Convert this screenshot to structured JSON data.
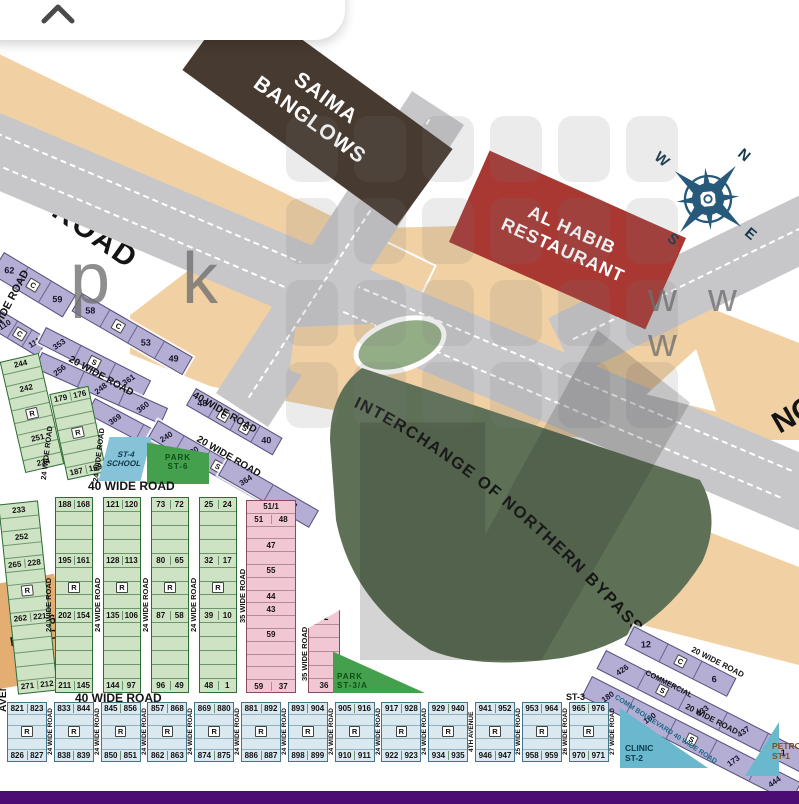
{
  "landmarks": {
    "saima": [
      "SAIMA",
      "BANGLOWS"
    ],
    "alhabib": [
      "AL HABIB",
      "RESTAURANT"
    ],
    "interchange": "INTERCHANGE OF NORTHERN BYPASS",
    "masjid": [
      "ST-6",
      "MASJID"
    ],
    "school": [
      "ST-4",
      "SCHOOL"
    ],
    "park_st6": [
      "PARK",
      "ST-6"
    ],
    "park_st3a": [
      "PARK",
      "ST-3/A"
    ],
    "clinic": [
      "CLINIC",
      "ST-2"
    ],
    "petrol": [
      "PETROL",
      "ST-1"
    ],
    "st3": "ST-3",
    "comm_boulevard": "COMM BOULEVARD 40 WIDE ROAD",
    "commercial": "COMMERCIAL",
    "northern_partial": "NO"
  },
  "compass": {
    "n": "N",
    "e": "E",
    "s": "S",
    "w": "W"
  },
  "watermarks": {
    "left": "p k",
    "right": "w w w"
  },
  "roads": {
    "top_left": "WIDE ROAD",
    "left_upper": "40 WIDE ROAD",
    "left_lower": "AVENUE 40 WIDE ROAD",
    "header_top": "40 WIDE ROAD",
    "header_bottom": "40 WIDE ROAD",
    "r20": "20 WIDE ROAD",
    "r40": "40 WIDE ROAD",
    "v24": "24 WIDE ROAD",
    "v35": "35 WIDE ROAD"
  },
  "strips": {
    "s1": [
      "62",
      "C",
      "59"
    ],
    "s2": [
      "58",
      "C",
      "53",
      "49"
    ],
    "s3": [
      "110",
      "C",
      "111"
    ],
    "s4": [
      "353",
      "S",
      "361"
    ],
    "s5": [
      "256",
      "248",
      "360"
    ],
    "s6": [
      "369",
      "241"
    ],
    "s7": [
      "48",
      "C",
      "S",
      "40"
    ],
    "s8": [
      "240",
      "230",
      "S",
      "231",
      "078"
    ],
    "s9": [
      "364",
      "223"
    ],
    "t1": [
      "12",
      "C",
      "6"
    ],
    "t2": [
      "426",
      "S",
      "433",
      "437",
      "1"
    ],
    "t3": [
      "180",
      "160",
      "S",
      "173",
      "444"
    ]
  },
  "greenUpper": {
    "colA": [
      "244",
      "",
      "242",
      "",
      "R",
      "",
      "251",
      "",
      "234"
    ],
    "colB": [
      "179 176",
      "",
      "",
      "R",
      "",
      "",
      "187 169"
    ]
  },
  "greenColumns": {
    "c1": [
      "233",
      "",
      "252",
      "",
      "265 228",
      "",
      "R",
      "",
      "262 221",
      "",
      "",
      "",
      "",
      "271 212"
    ],
    "c2": [
      "188 168",
      "",
      "",
      "",
      "195 161",
      "",
      "R",
      "",
      "202 154",
      "",
      "",
      "",
      "",
      "211 145"
    ],
    "c3": [
      "121 120",
      "",
      "",
      "",
      "128 113",
      "",
      "R",
      "",
      "135 106",
      "",
      "",
      "",
      "",
      "144 97"
    ],
    "c4": [
      "73 72",
      "",
      "",
      "",
      "80 65",
      "",
      "R",
      "",
      "87 58",
      "",
      "",
      "",
      "",
      "96 49"
    ],
    "c5": [
      "25 24",
      "",
      "",
      "",
      "32 17",
      "",
      "R",
      "",
      "39 10",
      "",
      "",
      "",
      "",
      "48 1"
    ]
  },
  "pink": {
    "col1": [
      "51/1",
      "51 48",
      "",
      "47",
      "",
      "55",
      "",
      "44",
      "43",
      "",
      "59",
      "",
      "",
      "",
      "59 37"
    ],
    "col2": [
      "32",
      "",
      "",
      "",
      "",
      "36"
    ]
  },
  "bottom": {
    "blocks": [
      {
        "top": "821 823",
        "bottom": "826 827"
      },
      {
        "top": "833 844",
        "bottom": "838 839"
      },
      {
        "top": "845 856",
        "bottom": "850 851"
      },
      {
        "top": "857 868",
        "bottom": "862 863"
      },
      {
        "top": "869 880",
        "bottom": "874 875"
      },
      {
        "top": "881 892",
        "bottom": "886 887"
      },
      {
        "top": "893 904",
        "bottom": "898 899"
      },
      {
        "top": "905 916",
        "bottom": "910 911"
      },
      {
        "top": "917 928",
        "bottom": "922 923"
      },
      {
        "top": "929 940",
        "bottom": "934 935"
      },
      {
        "top": "941 952",
        "bottom": "946 947"
      },
      {
        "top": "953 964",
        "bottom": "958 959"
      },
      {
        "top": "965 976",
        "bottom": "970 971"
      }
    ],
    "separators": [
      "24 WIDE ROAD",
      "24 WIDE ROAD",
      "24 WIDE ROAD",
      "24 WIDE ROAD",
      "24 WIDE ROAD",
      "24 WIDE ROAD",
      "24 WIDE ROAD",
      "24 WIDE ROAD",
      "24 WIDE ROAD",
      "4TH AVENUE",
      "25 WIDE ROAD",
      "26 WIDE ROAD",
      "27 WIDE ROAD"
    ]
  },
  "colors": {
    "road_grey": "#c7c7c9",
    "tan": "#f1d1a4",
    "saima_brown": "#473a31",
    "alhabib_red": "#a93833",
    "interchange_green": "#5e7157",
    "park_green": "#44a04c",
    "school_blue": "#86c3d8",
    "clinic_teal": "#6ab8cd",
    "plot_purple": "#b5aed4",
    "plot_green": "#cde3c3",
    "plot_pink": "#f2c7d4",
    "plot_blue": "#dae9ef",
    "compass_blue": "#27597a",
    "bottom_bar": "#4b0d71"
  }
}
